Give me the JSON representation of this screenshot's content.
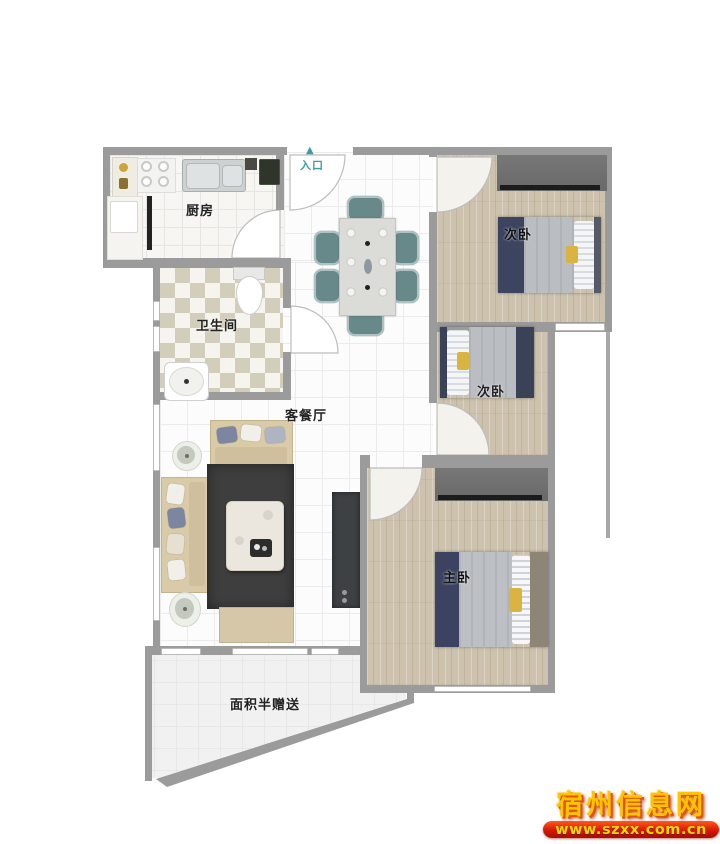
{
  "floorplan": {
    "rooms": {
      "kitchen": {
        "label": "厨房"
      },
      "bathroom": {
        "label": "卫生间"
      },
      "living_dining": {
        "label": "客餐厅"
      },
      "bedroom_top_right": {
        "label": "次卧"
      },
      "bedroom_middle_right": {
        "label": "次卧"
      },
      "master_bedroom": {
        "label": "主卧"
      },
      "balcony": {
        "label": "面积半赠送"
      }
    },
    "entrance": {
      "label": "入口",
      "arrow": "▲"
    },
    "colors": {
      "wall": "#9b9b9b",
      "wood_floor": "#ccc2ad",
      "rug": "#3e3e3e",
      "sofa": "#d9caa8",
      "dining_chair": "#67898a",
      "bed_navy": "#3c4460",
      "bed_blanket": "#babec2",
      "accent_yellow": "#d9b440",
      "wardrobe": "#6e6e6e",
      "entrance_teal": "#3f9d9d"
    }
  },
  "watermark": {
    "site_name": "宿州信息网",
    "site_url": "www.szxx.com.cn"
  }
}
